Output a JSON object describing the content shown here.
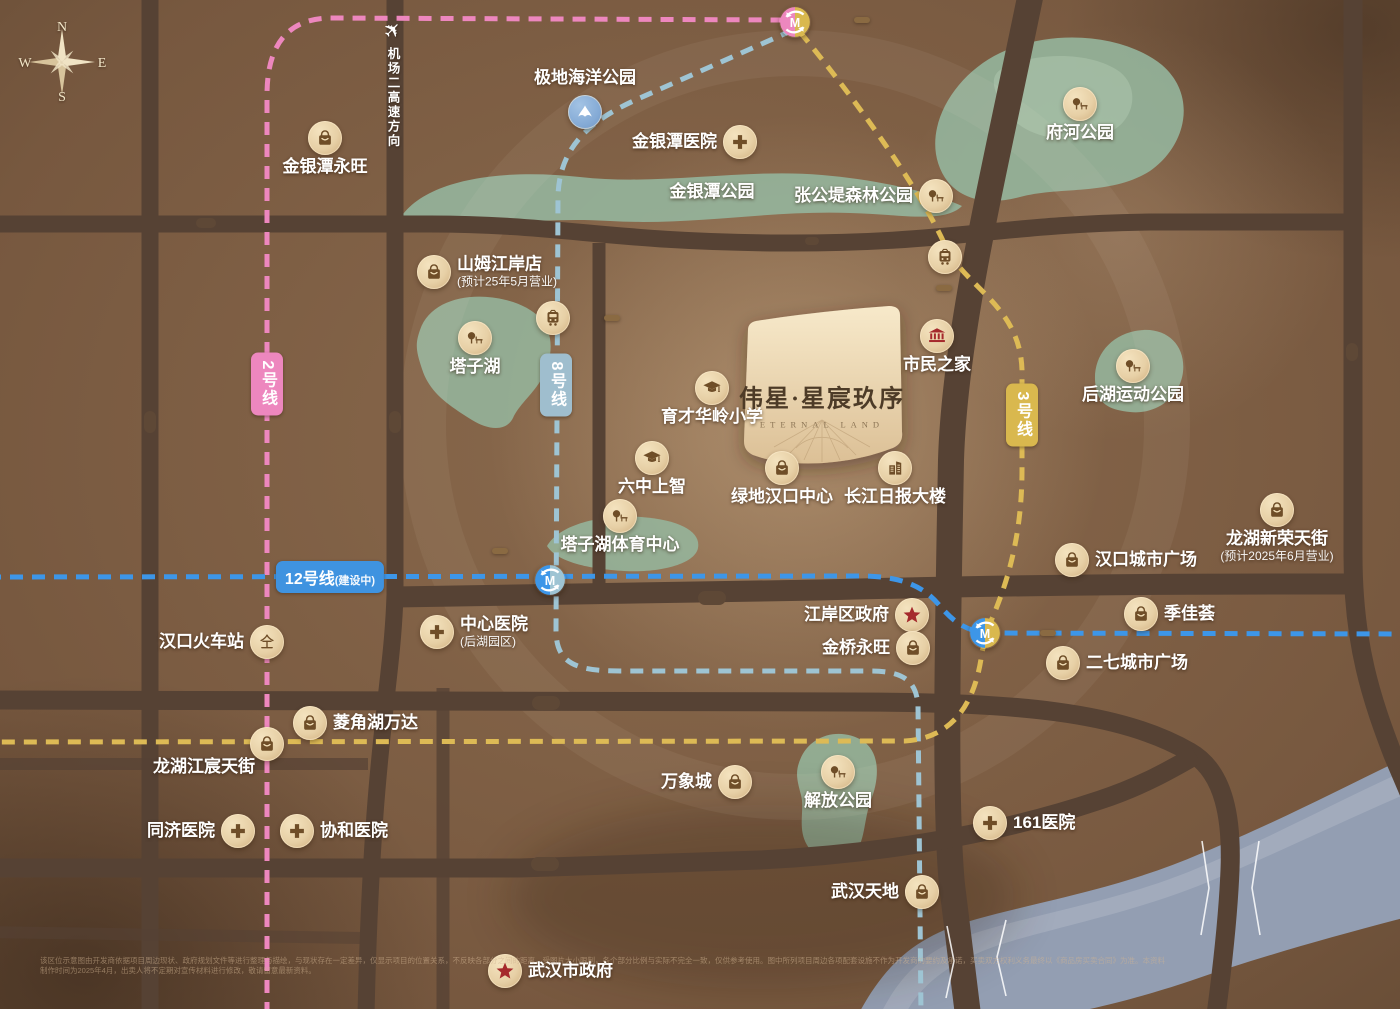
{
  "colors": {
    "line2_pink": "#ED87BE",
    "line8_teal": "#9EC4D3",
    "line3_gold": "#DDBA55",
    "line12_blue": "#3D96E8",
    "road": "#564234",
    "road_badge": "#5E4836",
    "station_badge": "#8A6A42",
    "icon_tan": "#E9D3AC",
    "icon_glyph": "#6F4E28",
    "accent_red": "#B8292B",
    "green_area": "#95B59C",
    "river_blue": "#939EB2",
    "title_tan": "#DCC69E",
    "project_card": "#F2E2C2"
  },
  "compass": {
    "n": "N",
    "e": "E",
    "s": "S",
    "w": "W"
  },
  "project": {
    "name": "伟星·星宸玖序",
    "name_en": "ETERNAL LAND"
  },
  "airport": {
    "text": "机场二高速方向",
    "plane_icon": "airplane-icon"
  },
  "area_titles": [
    {
      "label": "塔子湖核心生活圈",
      "x": 713,
      "y": 278,
      "cls": "t-xl"
    },
    {
      "label": "汉口历史风貌区",
      "x": 728,
      "y": 890,
      "cls": "t-l"
    },
    {
      "label": "二七滨江商务区",
      "x": 1094,
      "y": 891,
      "cls": "t-l"
    }
  ],
  "road_labels": [
    {
      "label": "三环线",
      "x": 206,
      "y": 223,
      "cls": "h-m"
    },
    {
      "label": "兆瑞大道",
      "x": 812,
      "y": 241,
      "cls": "h-s"
    },
    {
      "label": "后湖大道",
      "x": 712,
      "y": 598,
      "cls": "h-l"
    },
    {
      "label": "二环线",
      "x": 546,
      "y": 703,
      "cls": "h-l"
    },
    {
      "label": "解放大道",
      "x": 545,
      "y": 864,
      "cls": "h-l"
    },
    {
      "label": "常青路",
      "x": 150,
      "y": 422,
      "cls": "v"
    },
    {
      "label": "香港路",
      "x": 395,
      "y": 422,
      "cls": "v"
    },
    {
      "label": "武汉大道",
      "x": 962,
      "y": 450,
      "cls": "v bare"
    },
    {
      "label": "解放大道",
      "x": 1352,
      "y": 352,
      "cls": "v-big"
    }
  ],
  "metro_badges": [
    {
      "label": "2号线",
      "x": 267,
      "y": 384,
      "cls": "v",
      "color": "#ED87BE"
    },
    {
      "label": "8号线",
      "x": 556,
      "y": 385,
      "cls": "v",
      "color": "#9FBECE"
    },
    {
      "label": "3号线",
      "x": 1022,
      "y": 415,
      "cls": "v",
      "color": "#D9B84E"
    },
    {
      "label": "12号线",
      "sub": "(建设中)",
      "x": 330,
      "y": 577,
      "cls": "h",
      "color": "#3F93E0"
    }
  ],
  "station_icons": [
    {
      "label": "宏图大道站",
      "x": 795,
      "y": 22,
      "icon": "m-pink-gold",
      "cls": "c-bare"
    },
    {
      "label": "塔子湖站",
      "x": 553,
      "y": 318,
      "icon": "tram",
      "cls": ""
    },
    {
      "label": "市民之家站",
      "x": 945,
      "y": 257,
      "icon": "tram",
      "cls": ""
    },
    {
      "label": "中一路站",
      "x": 550,
      "y": 580,
      "icon": "m-blue-teal",
      "cls": "c-bare"
    },
    {
      "label": "兴业路站",
      "x": 985,
      "y": 633,
      "icon": "m-blue-gold",
      "cls": "c-bare"
    }
  ],
  "station_badges": [
    {
      "label": "宏图大道站",
      "x": 862,
      "y": 20
    },
    {
      "label": "塔子湖站",
      "x": 612,
      "y": 318
    },
    {
      "label": "市民之家站",
      "x": 944,
      "y": 288
    },
    {
      "label": "中一路站",
      "x": 500,
      "y": 551
    },
    {
      "label": "兴业路站",
      "x": 1048,
      "y": 633
    }
  ],
  "pois": [
    {
      "label": "金银潭永旺",
      "x": 325,
      "y": 138,
      "icon": "bag",
      "cls": "pos-below"
    },
    {
      "label": "极地海洋公园",
      "x": 585,
      "y": 112,
      "icon": "whale",
      "cls": "pos-above c-blue"
    },
    {
      "label": "金银潭医院",
      "x": 740,
      "y": 142,
      "icon": "cross",
      "cls": "pos-left"
    },
    {
      "label": "金银潭公园",
      "x": 712,
      "y": 192,
      "icon": "",
      "cls": "pos-center"
    },
    {
      "label": "张公堤森林公园",
      "x": 936,
      "y": 196,
      "icon": "park",
      "cls": "pos-left"
    },
    {
      "label": "府河公园",
      "x": 1080,
      "y": 104,
      "icon": "park",
      "cls": "pos-below"
    },
    {
      "label": "山姆江岸店",
      "sub": "(预计25年5月营业)",
      "x": 434,
      "y": 272,
      "icon": "bag",
      "cls": "pos-right"
    },
    {
      "label": "塔子湖",
      "x": 475,
      "y": 338,
      "icon": "park",
      "cls": "pos-below"
    },
    {
      "label": "市民之家",
      "x": 937,
      "y": 336,
      "icon": "museum",
      "cls": "pos-below g-red"
    },
    {
      "label": "育才华岭小学",
      "x": 712,
      "y": 388,
      "icon": "school",
      "cls": "pos-below"
    },
    {
      "label": "后湖运动公园",
      "x": 1133,
      "y": 366,
      "icon": "park",
      "cls": "pos-below"
    },
    {
      "label": "六中上智",
      "x": 652,
      "y": 458,
      "icon": "school",
      "cls": "pos-below"
    },
    {
      "label": "绿地汉口中心",
      "x": 782,
      "y": 468,
      "icon": "bag",
      "cls": "pos-below"
    },
    {
      "label": "长江日报大楼",
      "x": 895,
      "y": 468,
      "icon": "building",
      "cls": "pos-below"
    },
    {
      "label": "龙湖新荣天街",
      "sub": "(预计2025年6月营业)",
      "x": 1277,
      "y": 510,
      "icon": "bag",
      "cls": "pos-below"
    },
    {
      "label": "塔子湖体育中心",
      "x": 620,
      "y": 516,
      "icon": "park",
      "cls": "pos-below"
    },
    {
      "label": "汉口城市广场",
      "x": 1072,
      "y": 560,
      "icon": "bag",
      "cls": "pos-right"
    },
    {
      "label": "中心医院",
      "sub": "(后湖园区)",
      "x": 437,
      "y": 632,
      "icon": "cross",
      "cls": "pos-right"
    },
    {
      "label": "汉口火车站",
      "x": 267,
      "y": 642,
      "icon": "rail",
      "cls": "pos-left"
    },
    {
      "label": "江岸区政府",
      "x": 912,
      "y": 615,
      "icon": "star",
      "cls": "pos-left g-red"
    },
    {
      "label": "金桥永旺",
      "x": 913,
      "y": 648,
      "icon": "bag",
      "cls": "pos-left"
    },
    {
      "label": "季佳荟",
      "x": 1141,
      "y": 614,
      "icon": "bag",
      "cls": "pos-right"
    },
    {
      "label": "二七城市广场",
      "x": 1063,
      "y": 663,
      "icon": "bag",
      "cls": "pos-right"
    },
    {
      "label": "菱角湖万达",
      "x": 310,
      "y": 723,
      "icon": "bag",
      "cls": "pos-right"
    },
    {
      "label": "龙湖江宸天街",
      "x": 267,
      "y": 744,
      "icon": "bag",
      "cls": "pos-lb"
    },
    {
      "label": "同济医院",
      "x": 238,
      "y": 831,
      "icon": "cross",
      "cls": "pos-left"
    },
    {
      "label": "协和医院",
      "x": 297,
      "y": 831,
      "icon": "cross",
      "cls": "pos-right"
    },
    {
      "label": "万象城",
      "x": 735,
      "y": 782,
      "icon": "bag",
      "cls": "pos-left"
    },
    {
      "label": "解放公园",
      "x": 838,
      "y": 772,
      "icon": "park",
      "cls": "pos-below"
    },
    {
      "label": "161医院",
      "x": 990,
      "y": 823,
      "icon": "cross",
      "cls": "pos-right"
    },
    {
      "label": "武汉天地",
      "x": 922,
      "y": 892,
      "icon": "bag",
      "cls": "pos-left"
    },
    {
      "label": "武汉市政府",
      "x": 505,
      "y": 971,
      "icon": "star",
      "cls": "pos-right g-red"
    }
  ],
  "river": {
    "chars": [
      {
        "label": "长",
        "x": 1317,
        "y": 847,
        "cls": ""
      },
      {
        "label": "江",
        "x": 1070,
        "y": 940,
        "cls": ""
      }
    ],
    "bridges": [
      {
        "label": "长江二桥",
        "x": 976,
        "y": 960,
        "cls": "rot"
      },
      {
        "label": "二七长江大桥",
        "x": 1229,
        "y": 888,
        "cls": ""
      }
    ]
  },
  "disclaimer": {
    "text": "该区位示意图由开发商依据项目周边现状、政府规划文件等进行整理与描绘，与现状存在一定差异，仅显示项目的位置关系，不反映各部分之间的距离，受图片大小限制，各个部分比例与实际不完全一致，仅供参考使用。图中所列项目周边各项配套设施不作为开发商的要约及承诺，买卖双方权利义务最终以《商品房买卖合同》为准。本资料制作时间为2025年4月，出卖人将不定期对宣传材料进行修改，敬请留意最新资料。"
  }
}
